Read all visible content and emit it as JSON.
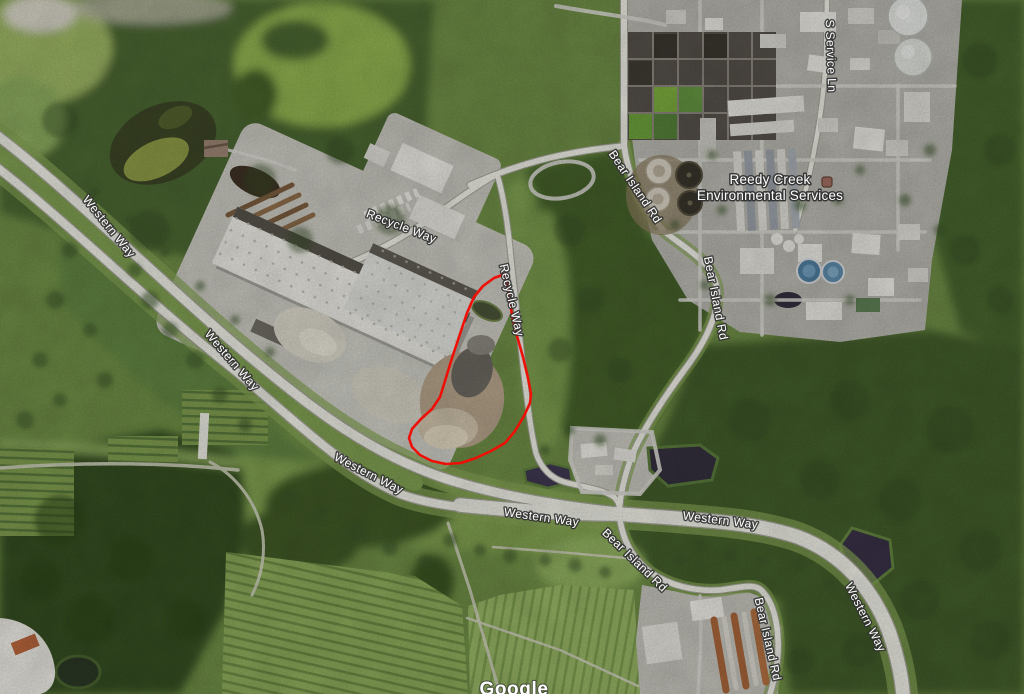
{
  "map_view": {
    "type": "satellite-imagery",
    "description": "aerial view of recycling facility and Reedy Creek water treatment plant with red site-boundary overlay"
  },
  "road_labels": {
    "western_way": "Western Way",
    "recycle_way": "Recycle Way",
    "bear_island_rd": "Bear Island Rd",
    "s_service_ln": "S Service Ln"
  },
  "poi": {
    "line1": "Reedy Creek",
    "line2": "Environmental Services",
    "marker_color": "#82594e"
  },
  "annotation": {
    "shape": "site-boundary-outline",
    "color": "#ee1007"
  },
  "watermark": {
    "text": "Google"
  }
}
